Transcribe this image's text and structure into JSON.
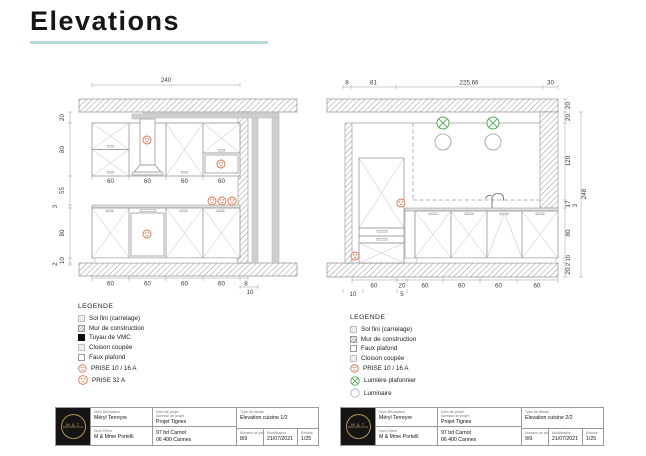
{
  "header": {
    "title": "Elevations",
    "accent_color": "#b5d9d4"
  },
  "colors": {
    "outlet": "#e0714a",
    "ceiling_light": "#5aa85a",
    "logo_gold": "#b5924f"
  },
  "left_elevation": {
    "drawing_name": "Elevation cuisine 1/2",
    "top_dim": "240",
    "side_dims": [
      "20",
      "80",
      "55",
      "3",
      "80",
      "10",
      "2"
    ],
    "upper_widths": [
      "60",
      "60",
      "60",
      "60"
    ],
    "lower_widths": [
      "60",
      "60",
      "60",
      "60"
    ],
    "end_dims": [
      "8",
      "10"
    ]
  },
  "right_elevation": {
    "drawing_name": "Elevation cuisine 2/2",
    "top_dims": [
      "8",
      "81",
      "225,66",
      "30"
    ],
    "right_dims": [
      "20",
      "20",
      "120",
      "17",
      "80",
      "2 10",
      "20"
    ],
    "worktop_dim": "3",
    "total_height": "248",
    "bottom_widths": [
      "60",
      "20",
      "60",
      "60",
      "60",
      "60"
    ],
    "bottom_offsets": [
      "10",
      "5"
    ]
  },
  "legend_left": {
    "title": "LEGENDE",
    "items": [
      {
        "icon": "sol-fini-swatch",
        "label": "Sol fini (carrelage)"
      },
      {
        "icon": "mur-construction-swatch",
        "label": "Mur de construction"
      },
      {
        "icon": "tuyau-vmc-swatch",
        "label": "Tuyau de VMC"
      },
      {
        "icon": "cloison-coupee-swatch",
        "label": "Cloison coupée"
      },
      {
        "icon": "faux-plafond-swatch",
        "label": "Faux plafond"
      },
      {
        "icon": "prise-symbol",
        "label": "PRISE 10 / 16 A"
      },
      {
        "icon": "prise32-symbol",
        "label": "PRISE 32 A"
      }
    ]
  },
  "legend_right": {
    "title": "LEGENDE",
    "items": [
      {
        "icon": "sol-fini-swatch",
        "label": "Sol fini (carrelage)"
      },
      {
        "icon": "mur-construction-swatch",
        "label": "Mur de construction"
      },
      {
        "icon": "faux-plafond-swatch",
        "label": "Faux plafond"
      },
      {
        "icon": "cloison-coupee-swatch",
        "label": "Cloison coupée"
      },
      {
        "icon": "prise-symbol",
        "label": "PRISE 10 / 16 A"
      },
      {
        "icon": "plafonnier-symbol",
        "label": "Lumière plafonnier"
      },
      {
        "icon": "luminaire-symbol",
        "label": "Luminaire"
      }
    ]
  },
  "titleblock_left": {
    "logo_line1": "M & T",
    "logo_line2": "DÉCORATION",
    "designer_label": "Nom Décorateur",
    "designer": "Méryl Terreyre",
    "client_label": "Nom Client",
    "client": "M & Mme Portelli",
    "project_label": "Nom de projet",
    "address_label": "Adresse de projet",
    "project": "Projet Tignes",
    "address1": "97 bd Carnot",
    "address2": "06 400 Cannes",
    "type_label": "Type de dessin",
    "type": "Elevation cuisine 1/2",
    "page_label": "Numéro de page",
    "page": "8/9",
    "modif_label": "Modification",
    "modif": "21/07/2021",
    "scale_label": "Echelle",
    "scale": "1/25"
  },
  "titleblock_right": {
    "logo_line1": "M & T",
    "logo_line2": "DÉCORATION",
    "designer_label": "Nom Décorateur",
    "designer": "Méryl Terreyre",
    "client_label": "Nom Client",
    "client": "M & Mme Portelli",
    "project_label": "Nom de projet",
    "address_label": "Adresse de projet",
    "project": "Projet Tignes",
    "address1": "97 bd Carnot",
    "address2": "06 400 Cannes",
    "type_label": "Type de dessin",
    "type": "Elevation cuisine 2/2",
    "page_label": "Numéro de page",
    "page": "9/9",
    "modif_label": "Modification",
    "modif": "21/07/2021",
    "scale_label": "Echelle",
    "scale": "1/25"
  }
}
